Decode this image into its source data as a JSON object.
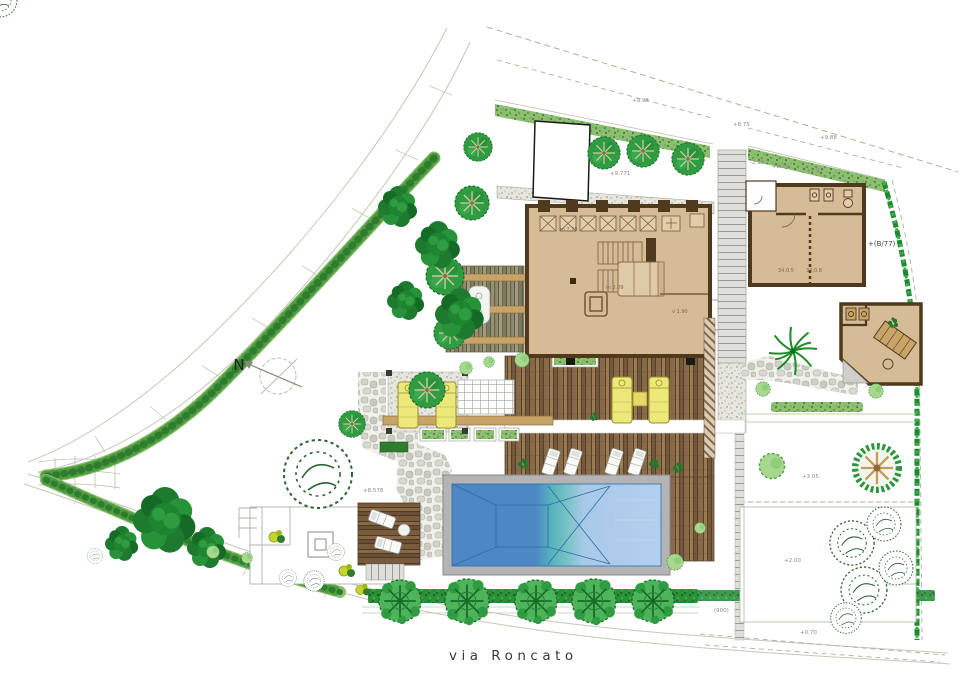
{
  "meta": {
    "type": "architectural landscape site plan",
    "sheet": "garden / villa plan"
  },
  "street": {
    "label": "via Roncato"
  },
  "compass": {
    "label": "N"
  },
  "annotations": {
    "parcel_ref": "+(B/77)",
    "elev_top_left": "+9.98",
    "elev_stair": "+8.75",
    "elev_top_right": "+9.88",
    "elev_guest_a": "-2.98",
    "elev_guest_b": "+8.30",
    "elev_guest_c": "+8.97",
    "elev_tree_row": "+9.771",
    "elev_court": "+8.578",
    "room_main_a": "m 2.28",
    "room_main_b": "m 2.09",
    "room_main_c": "v 1.90",
    "room_guest_a": "34.0.5",
    "room_guest_b": "34.0.8",
    "elev_lawn_a": "+3.05",
    "elev_lawn_b": "+2.00",
    "ref_bottom": "(900)",
    "elev_bottom": "+0.70"
  },
  "features": {
    "main_house": "main villa floor plan",
    "guest_house": "guest house floor plan",
    "sauna_building": "sauna / pool house",
    "garage": "white outbuilding",
    "pool": "swimming pool with depth contours",
    "wood_deck": "timber deck terraces",
    "pergola": "pergola with dining table",
    "fire_pit": "terrace fire pit",
    "tree_row": "row of five round trees with hedge",
    "north_arrow": "north compass"
  },
  "colors": {
    "paper": "#ffffff",
    "line_grey": "#c3c9b6",
    "boundary_dash": "#a9b29c",
    "hedge_light": "#8fbd72",
    "hedge_dark": "#1d8a2c",
    "tree_dark": "#1e7a2e",
    "tree_mid": "#2f9c42",
    "shrub_light": "#a8d890",
    "shrub_yellow": "#c6d42c",
    "branch_tan": "#c79a5d",
    "wall_brown": "#4f3a1e",
    "floor_tan": "#d6bb97",
    "beam_tan": "#c9a468",
    "lounger_yellow": "#ece87a",
    "pool_deep": "#4d88c4",
    "pool_teal": "#5fc0b4",
    "pool_light": "#a9c9e9",
    "gravel": "#e6e6df",
    "stone": "#cfcfc9",
    "text_grey": "#8b8b82"
  }
}
